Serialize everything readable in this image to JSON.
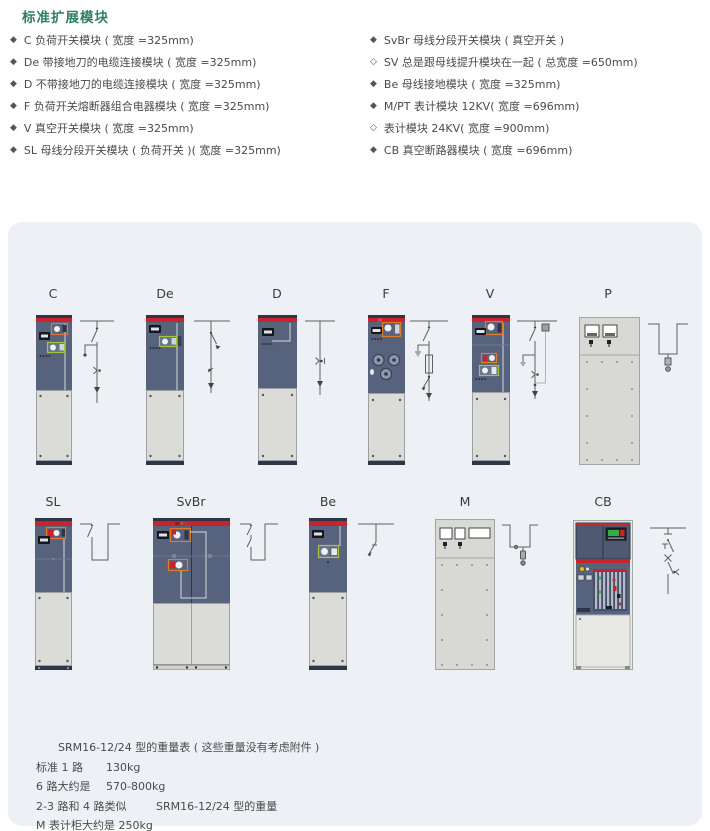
{
  "title": "标准扩展模块",
  "colors": {
    "title_green": "#2e7d68",
    "panel_bg": "#edf1f6",
    "cabinet_red": "#c8242b",
    "cabinet_slate": "#57627c"
  },
  "modules": {
    "left": [
      {
        "bullet": "◆",
        "text": "C 负荷开关模块 ( 宽度 =325mm)"
      },
      {
        "bullet": "◆",
        "text": "De 带接地刀的电缆连接模块 ( 宽度 =325mm)"
      },
      {
        "bullet": "◆",
        "text": "D 不带接地刀的电缆连接模块 ( 宽度 =325mm)"
      },
      {
        "bullet": "◆",
        "text": "F 负荷开关熔断器组合电器模块 ( 宽度 =325mm)"
      },
      {
        "bullet": "◆",
        "text": "V 真空开关模块 ( 宽度 =325mm)"
      },
      {
        "bullet": "◆",
        "text": "SL 母线分段开关模块 ( 负荷开关 )( 宽度 =325mm)"
      }
    ],
    "right": [
      {
        "bullet": "◆",
        "text": "SvBr 母线分段开关模块 ( 真空开关 )"
      },
      {
        "bullet": "◇",
        "text": "SV 总是跟母线提升模块在一起 ( 总宽度 =650mm)"
      },
      {
        "bullet": "◆",
        "text": "Be 母线接地模块 ( 宽度 =325mm)"
      },
      {
        "bullet": "◆",
        "text": "M/PT 表计模块 12KV( 宽度 =696mm)"
      },
      {
        "bullet": "◇",
        "text": "表计模块 24KV( 宽度 =900mm)"
      },
      {
        "bullet": "◆",
        "text": "CB 真空断路器模块 ( 宽度 =696mm)"
      }
    ]
  },
  "figures": {
    "row1": [
      {
        "label": "C"
      },
      {
        "label": "De"
      },
      {
        "label": "D"
      },
      {
        "label": "F"
      },
      {
        "label": "V"
      },
      {
        "label": "P"
      }
    ],
    "row2": [
      {
        "label": "SL"
      },
      {
        "label": "SvBr"
      },
      {
        "label": "Be"
      },
      {
        "label": "M"
      },
      {
        "label": "CB"
      }
    ]
  },
  "weights": {
    "lines": [
      {
        "label": "SRM16-12/24 型的重量表 ( 这些重量没有考虑附件 )",
        "value": ""
      },
      {
        "label": "标准 1 路",
        "value": "130kg"
      },
      {
        "label": "6 路大约是",
        "value": "570-800kg"
      },
      {
        "label": "2-3 路和 4 路类似",
        "value": "SRM16-12/24 型的重量"
      },
      {
        "label": "M 表计柜大约是 250kg",
        "value": ""
      }
    ]
  }
}
